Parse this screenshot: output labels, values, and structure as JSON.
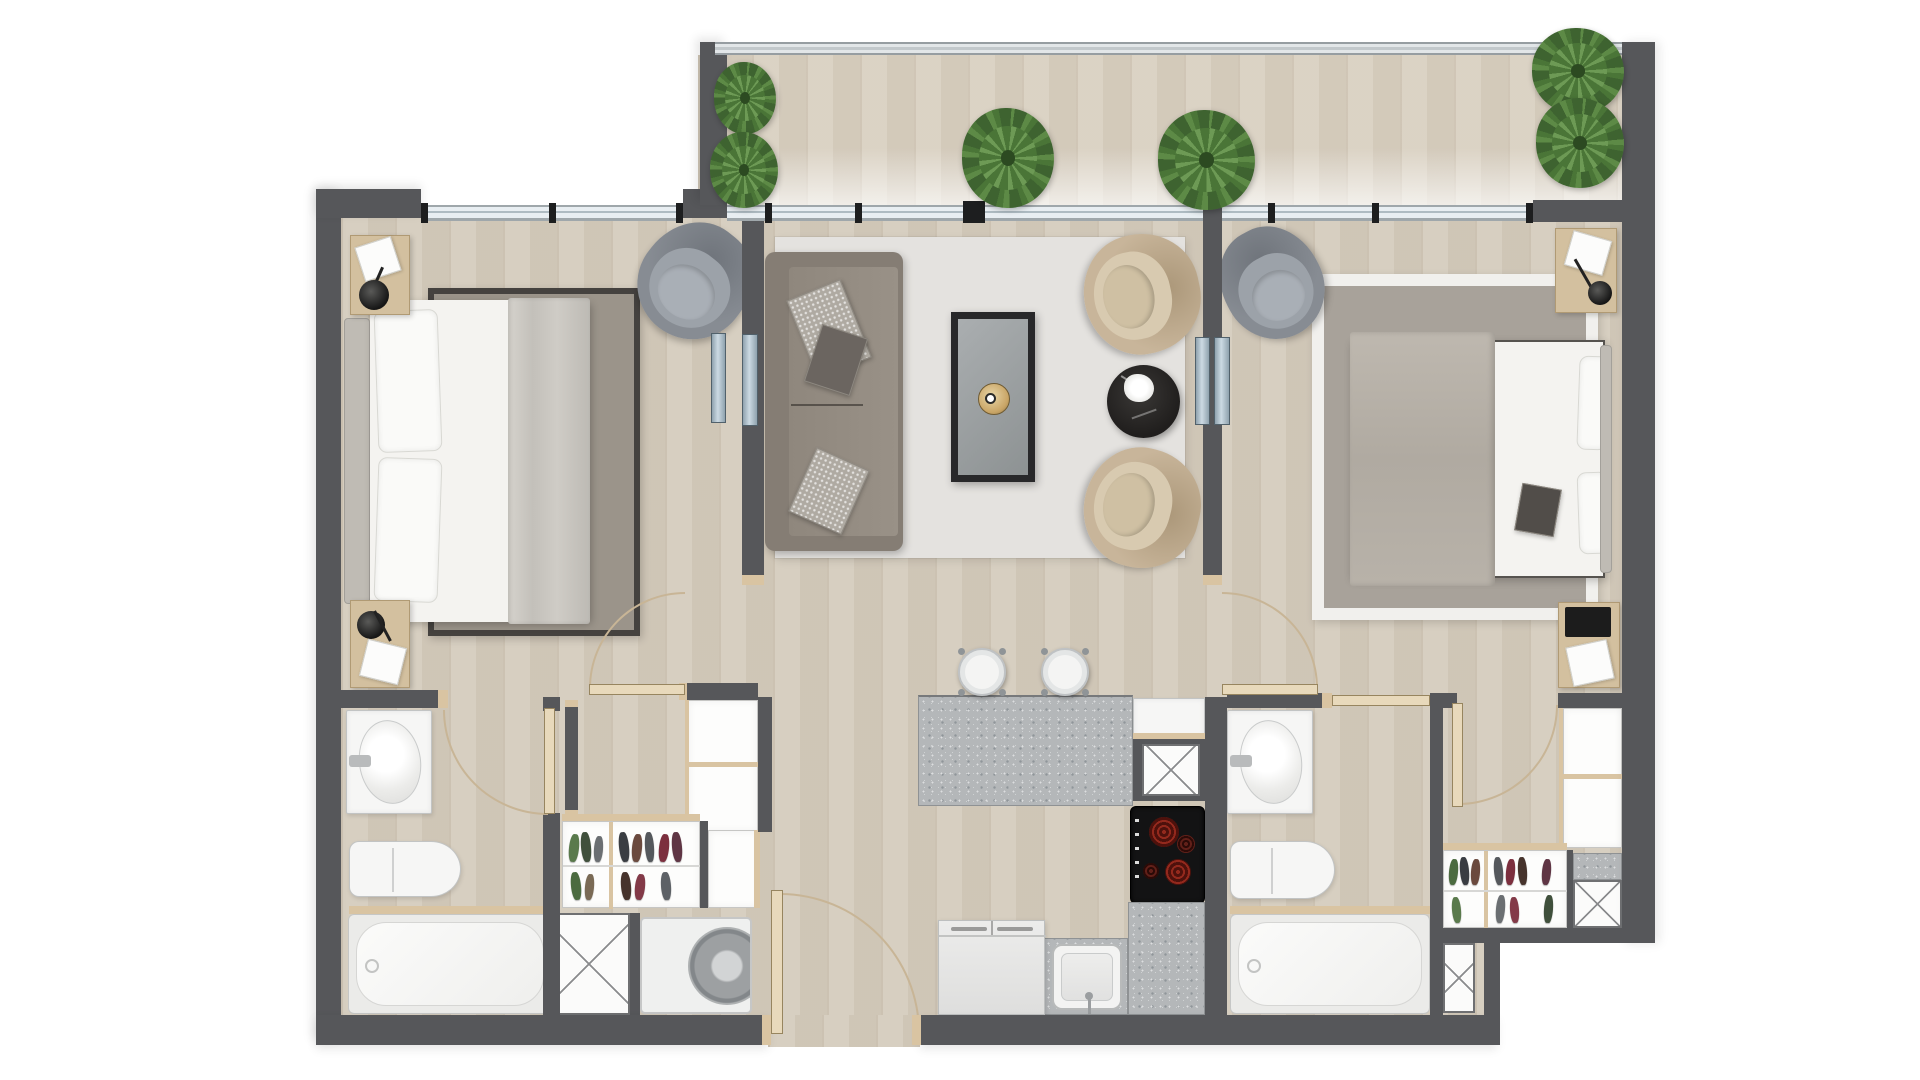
{
  "document": {
    "type": "apartment floor plan",
    "view": "top-down 2D render",
    "visible_text_labels": [],
    "units_shown": false
  },
  "palette": {
    "wall": "#56575a",
    "floor": "#d5ccbd",
    "balconyFloor": "#d9d0c1",
    "trim": "#d9c4a2",
    "doorLeaf": "#e8d9bb",
    "arc": "#c8b596",
    "windowGlass": "#e8eef2",
    "windowFrame": "#9fa7ab",
    "railing": "#c2c8cb",
    "rugLiving": "#e4e2df",
    "rugBedroom1": "#9b948a",
    "rugBedroom1Border": "#45423f",
    "rugBedroom2": "#a8a29a",
    "rugBedroom2Border": "#f1f0ed",
    "sofa": "#857d74",
    "beigeChair": "#c8b59a",
    "greyChair": "#878c93",
    "coffeeTableFrame": "#28282a",
    "goldTray": "#c9a566",
    "sideTable": "#201e1d",
    "granite": "#b4b7b9",
    "cooktop": "#131314",
    "burner": "#93291d",
    "fixtureWhite": "#f6f6f5",
    "plantGreen": "#5d8a46"
  },
  "rooms": [
    {
      "name": "balcony",
      "items": [
        "railing",
        "wood deck",
        "potted plant",
        "potted plant",
        "palm plant",
        "palm plant",
        "large corner plant"
      ]
    },
    {
      "name": "bedroom-1",
      "items": [
        "window",
        "nightstand with lamp",
        "nightstand with tray",
        "double bed",
        "pillows",
        "folded blanket",
        "area rug",
        "grey lounge armchair",
        "sliding glass panels",
        "door"
      ]
    },
    {
      "name": "living-room",
      "items": [
        "sliding balcony window",
        "area rug",
        "three-seat sofa",
        "patterned cushion",
        "patterned cushion",
        "dark cushion",
        "coffee table",
        "gold tray",
        "beige accent armchair",
        "beige accent armchair",
        "black round side table",
        "white flowers"
      ]
    },
    {
      "name": "kitchen",
      "items": [
        "granite island",
        "bar stool",
        "bar stool",
        "white counter cabinet",
        "service duct",
        "4-burner cooktop",
        "granite counter",
        "kitchen sink",
        "double-door refrigerator"
      ]
    },
    {
      "name": "entry",
      "items": [
        "entry door",
        "door swing arc"
      ]
    },
    {
      "name": "closet-hall-bedroom-1",
      "items": [
        "wardrobe shelves",
        "shoe rack",
        "cabinet",
        "service duct",
        "washing machine"
      ]
    },
    {
      "name": "bathroom-1",
      "items": [
        "vanity sink",
        "toilet",
        "bathtub",
        "door"
      ]
    },
    {
      "name": "bedroom-2",
      "items": [
        "window",
        "grey lounge armchair",
        "area rug",
        "double bed",
        "pillows",
        "dark accent pillow",
        "nightstand",
        "nightstand",
        "sliding glass panels",
        "door"
      ]
    },
    {
      "name": "walk-in-closet-2",
      "items": [
        "wardrobe shelves",
        "shoe rack",
        "service duct",
        "service duct",
        "door"
      ]
    },
    {
      "name": "bathroom-2",
      "items": [
        "vanity sink",
        "toilet",
        "bathtub",
        "door"
      ]
    }
  ]
}
